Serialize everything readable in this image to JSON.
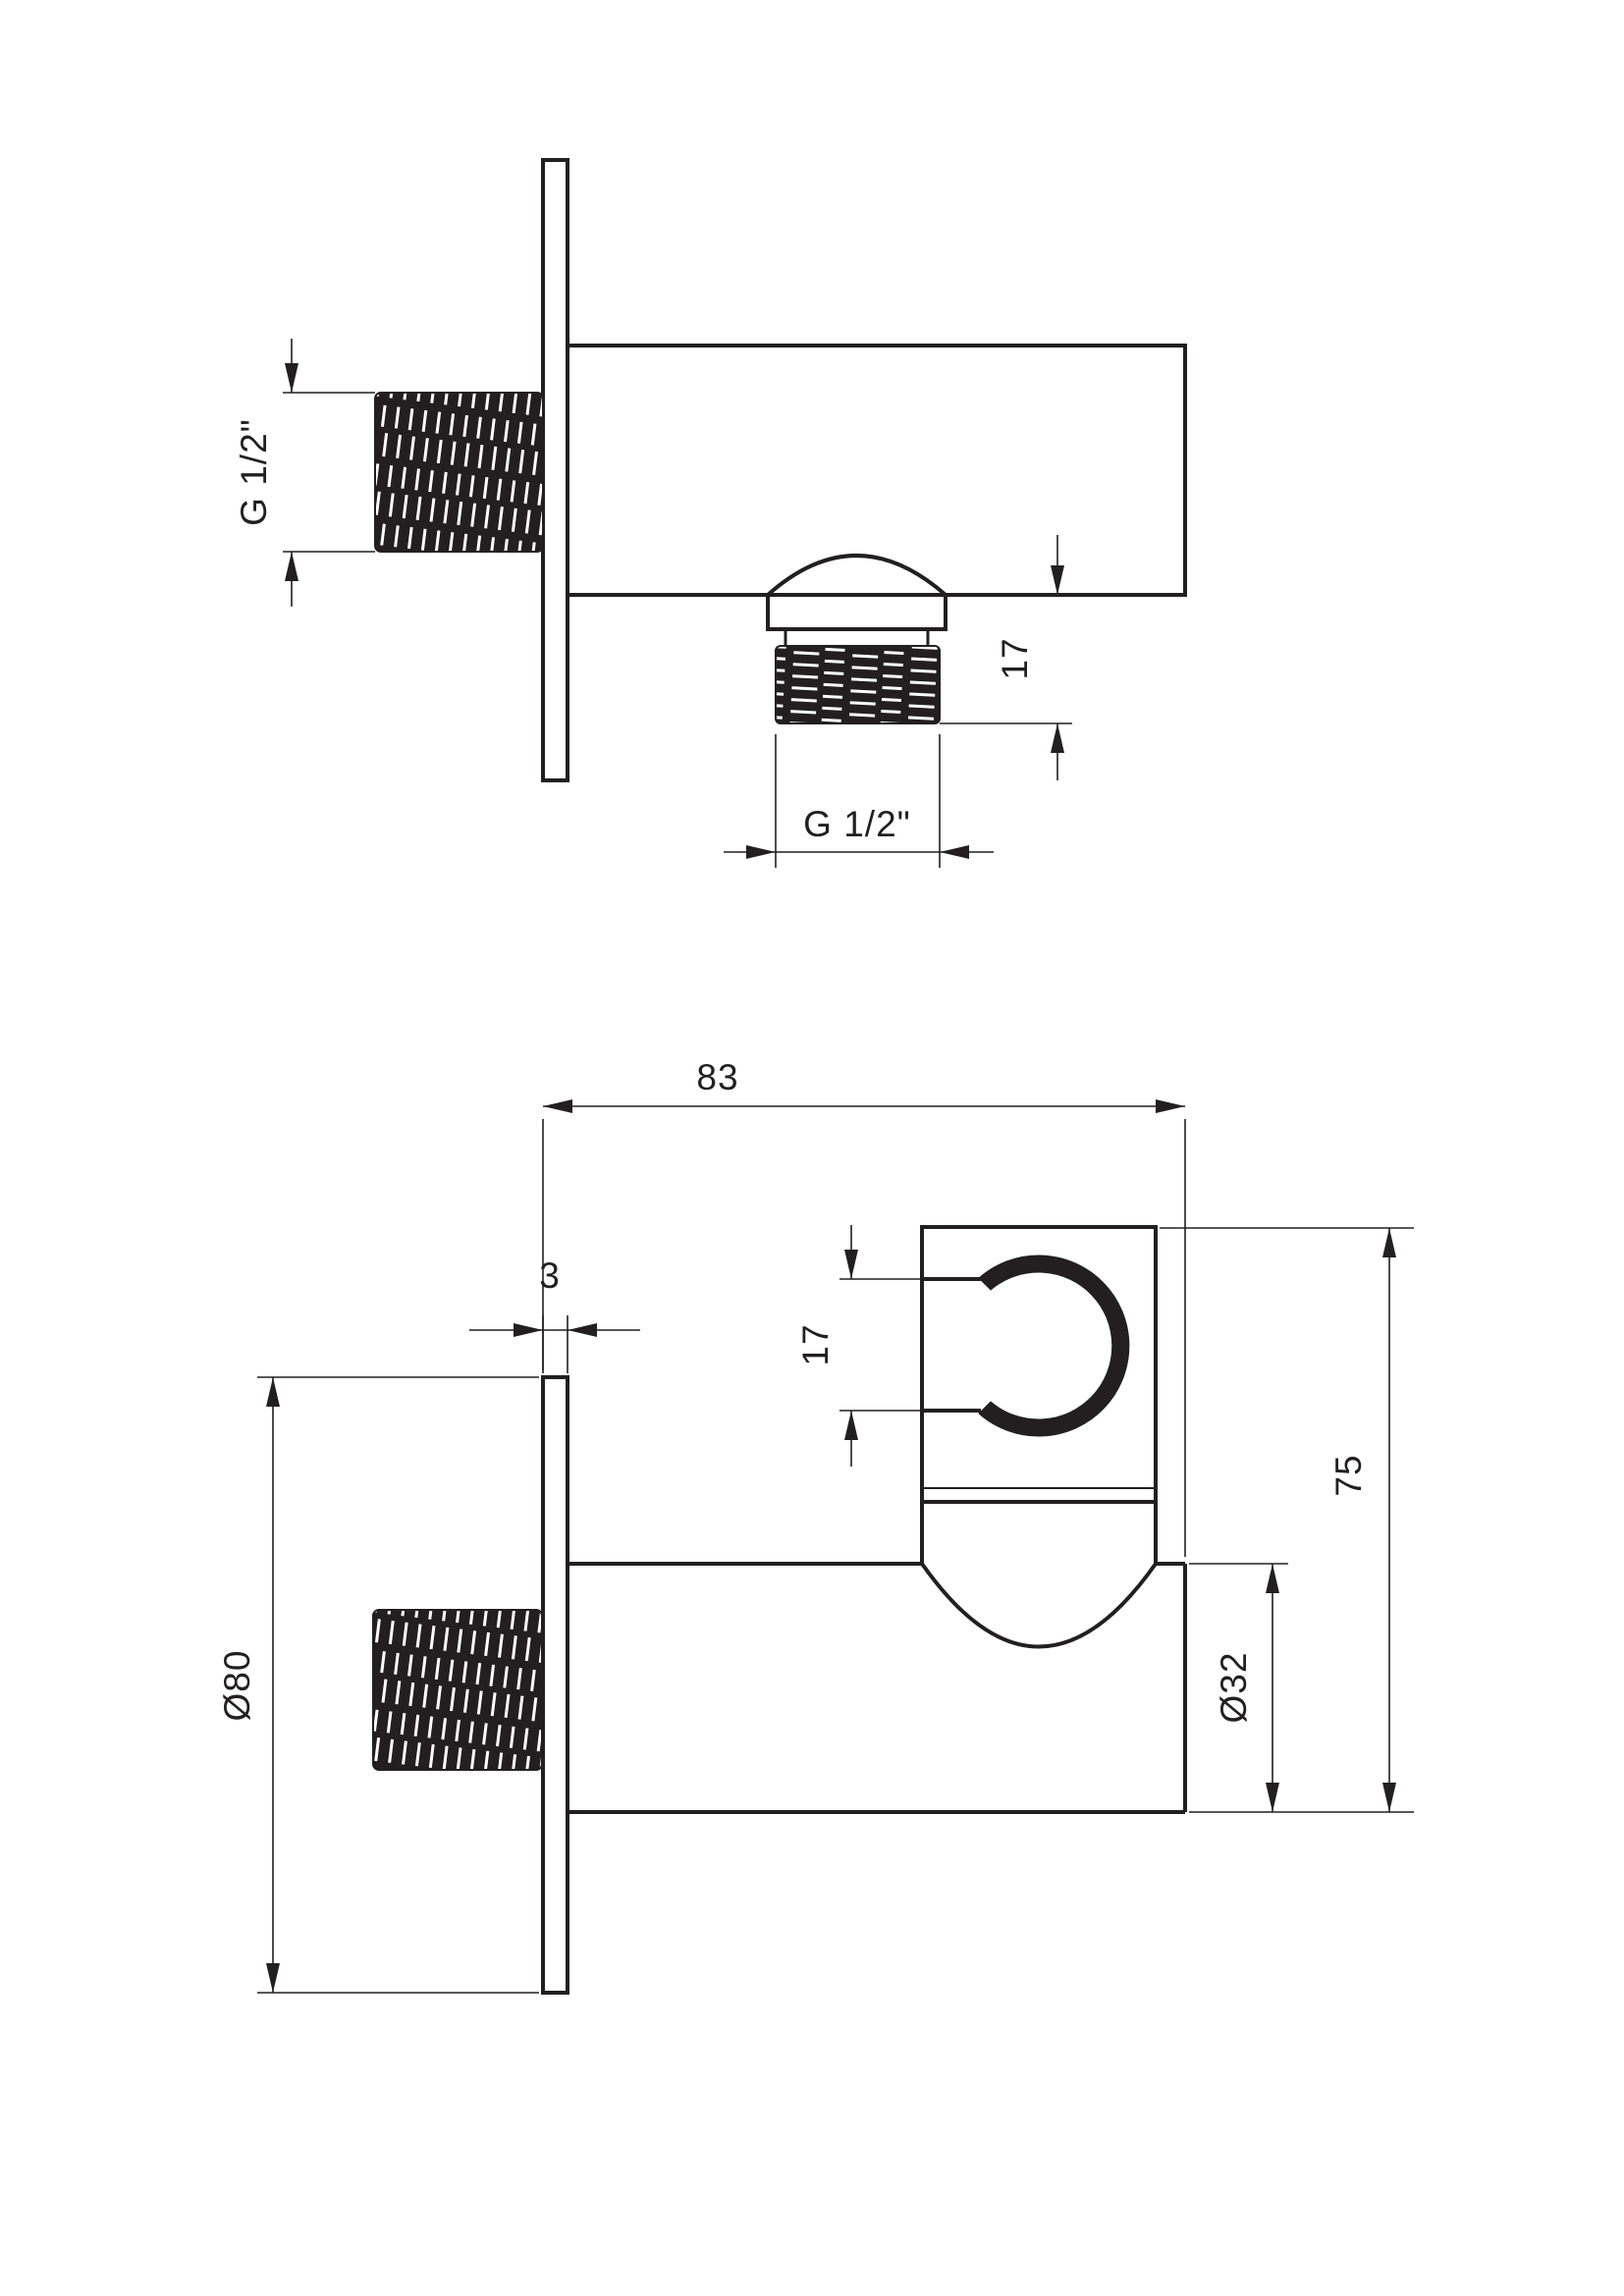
{
  "drawing": {
    "background_color": "#ffffff",
    "line_color": "#231f20",
    "top_view": {
      "inlet_thread_label": "G 1/2\"",
      "outlet_thread_label": "G 1/2\"",
      "outlet_height_label": "17"
    },
    "bottom_view": {
      "overall_depth_label": "83",
      "plate_thickness_label": "3",
      "holder_slot_label": "17",
      "overall_height_label": "75",
      "body_diameter_label": "Ø32",
      "plate_diameter_label": "Ø80"
    }
  }
}
